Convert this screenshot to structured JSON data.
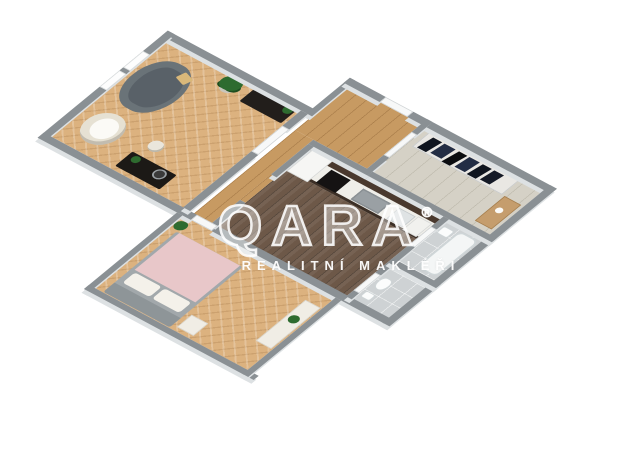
{
  "watermark": {
    "brand": "QARA",
    "registered": "®",
    "subtitle": "REALITNÍ MAKLÉŘI"
  },
  "scene": {
    "type": "3d-floorplan-render",
    "rooms": [
      "living-room",
      "corridor",
      "entry-vestibule",
      "hall",
      "kitchen",
      "bathroom",
      "wc",
      "bedroom"
    ]
  },
  "palette": {
    "bg": "#ffffff",
    "wall": "#8a9094",
    "wall-face": "#dde1e3",
    "door": "#f7f8f8",
    "herringbone": "#dcb27f",
    "plank": "#c79a62",
    "hall-floor": "#d5d1c6",
    "kitchen-floor": "#6d5848",
    "tile": "#ced2d4",
    "sofa": "#6a7378",
    "sofa-cushion": "#596168",
    "sofa-pillow": "#d9b87a",
    "armchair": "#e6e1d3",
    "plant-green": "#2e6b2f",
    "plant-pot": "#c9c6bc",
    "dark-furniture": "#221e1b",
    "counter": "#efeee9",
    "counter-back": "#4a392e",
    "oven": "#151313",
    "cooktop": "#9aa0a4",
    "fridge": "#f6f6f4",
    "sink": "#dfe3e4",
    "bed-blanket": "#e8c7c9",
    "bed-frame": "#a2a8ab",
    "bed-headboard": "#8e9598",
    "pillow": "#f4f1ea",
    "white-furniture": "#f0ede5",
    "wood-console": "#c59d6d",
    "clothes-dark-1": "#10151f",
    "clothes-dark-2": "#232d44",
    "tub": "#f4f6f6"
  }
}
